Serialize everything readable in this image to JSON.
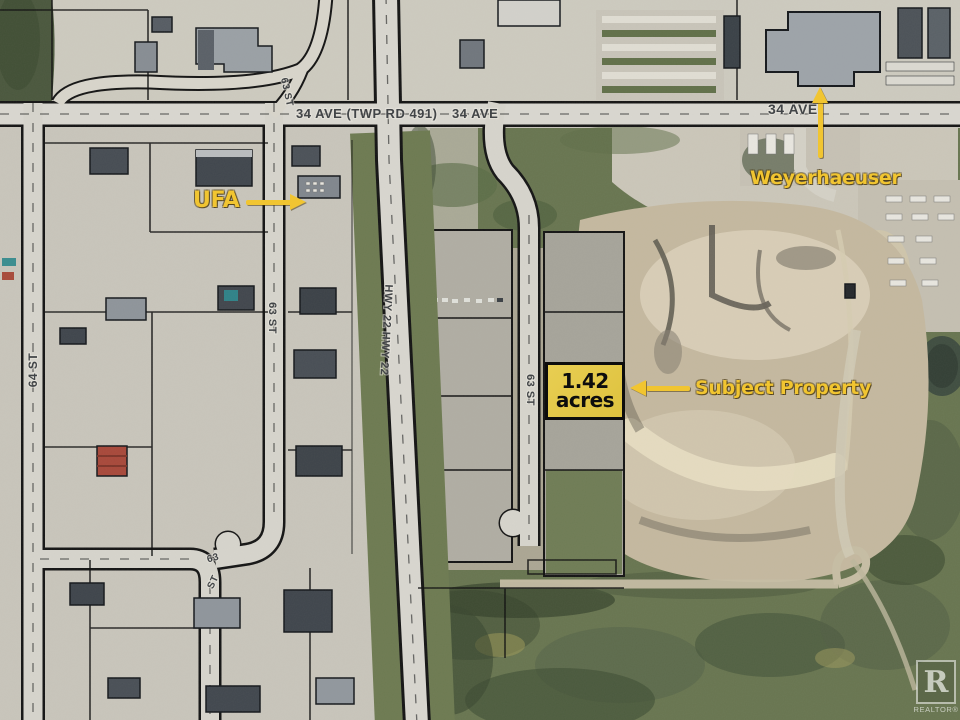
{
  "map": {
    "road_labels": {
      "ave34_left": "34 AVE (TWP RD 491)",
      "ave34_mid": "34 AVE",
      "ave34_right": "34 AVE",
      "st64": "64 ST",
      "st63_north": "63 ST",
      "st63_ramp": "63 ST",
      "st63_east": "63 ST",
      "st63_curve_top": "63",
      "st63_curve_bottom": "ST",
      "hwy22": "HWY 22   HWY 22"
    },
    "annotations": {
      "ufa": "UFA",
      "weyerhaeuser": "Weyerhaeuser",
      "subject_property": "Subject Property",
      "acreage_line1": "1.42",
      "acreage_line2": "acres"
    },
    "watermark": {
      "letter": "R",
      "label": "REALTOR®"
    },
    "colors": {
      "annotation_yellow": "#F1C531",
      "parcel_highlight": "#E4C94B",
      "road_label_gray": "#3F4245"
    }
  }
}
